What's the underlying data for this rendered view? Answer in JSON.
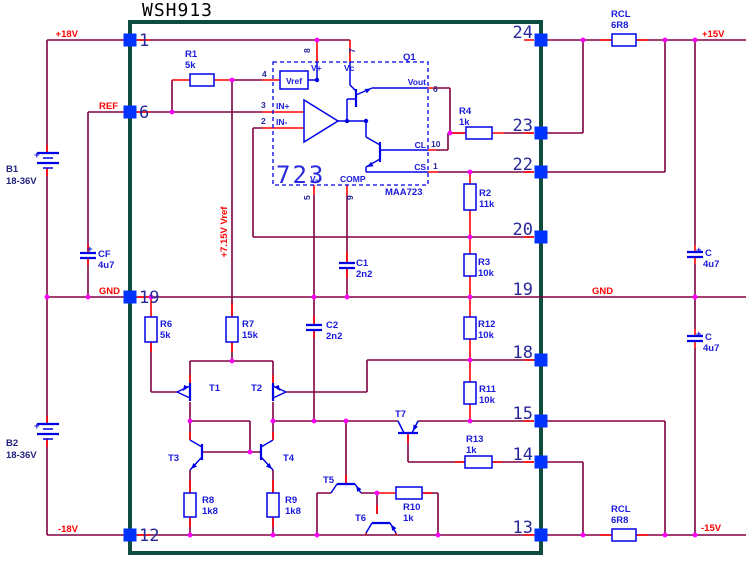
{
  "ic": {
    "title": "WSH913",
    "regulator_label": "723",
    "regulator_part": "MAA723",
    "regulator_designator": "Q1"
  },
  "pins": {
    "left": [
      {
        "n": "1",
        "y": 40
      },
      {
        "n": "6",
        "y": 112
      },
      {
        "n": "19",
        "y": 297
      },
      {
        "n": "12",
        "y": 535
      }
    ],
    "right": [
      {
        "n": "24",
        "y": 40
      },
      {
        "n": "23",
        "y": 133
      },
      {
        "n": "22",
        "y": 172
      },
      {
        "n": "20",
        "y": 237
      },
      {
        "n": "19",
        "y": 297,
        "square": false
      },
      {
        "n": "18",
        "y": 360
      },
      {
        "n": "15",
        "y": 421
      },
      {
        "n": "14",
        "y": 462
      },
      {
        "n": "13",
        "y": 535
      }
    ]
  },
  "labels": [
    {
      "name": "title",
      "text": "WSH913",
      "x": 142,
      "y": 16,
      "cls": "t-title"
    },
    {
      "name": "net-p18v",
      "text": "+18V",
      "x": 78,
      "y": 37,
      "cls": "t-net",
      "anchor": "end"
    },
    {
      "name": "net-ref",
      "text": "REF",
      "x": 118,
      "y": 109,
      "cls": "t-net",
      "anchor": "end"
    },
    {
      "name": "net-gnd-left",
      "text": "GND",
      "x": 120,
      "y": 294,
      "cls": "t-net",
      "anchor": "end"
    },
    {
      "name": "net-m18v",
      "text": "-18V",
      "x": 78,
      "y": 532,
      "cls": "t-net",
      "anchor": "end"
    },
    {
      "name": "net-p15v",
      "text": "+15V",
      "x": 702,
      "y": 37,
      "cls": "t-net"
    },
    {
      "name": "net-gnd-right",
      "text": "GND",
      "x": 592,
      "y": 294,
      "cls": "t-net"
    },
    {
      "name": "net-m15v",
      "text": "-15V",
      "x": 701,
      "y": 531,
      "cls": "t-net"
    },
    {
      "name": "net-vref-rail",
      "text": "+7.15V Vref",
      "x": 227,
      "y": 232,
      "cls": "t-net",
      "anchor": "middle",
      "rot": -90
    },
    {
      "name": "b1-ref",
      "text": "B1",
      "x": 6,
      "y": 172,
      "cls": "t-bat"
    },
    {
      "name": "b1-val",
      "text": "18-36V",
      "x": 6,
      "y": 184,
      "cls": "t-bat"
    },
    {
      "name": "b2-ref",
      "text": "B2",
      "x": 6,
      "y": 446,
      "cls": "t-bat"
    },
    {
      "name": "b2-val",
      "text": "18-36V",
      "x": 6,
      "y": 458,
      "cls": "t-bat"
    },
    {
      "name": "b1-plus",
      "text": "+",
      "x": 34,
      "y": 158,
      "cls": "t-cmp"
    },
    {
      "name": "b2-plus",
      "text": "+",
      "x": 34,
      "y": 429,
      "cls": "t-cmp"
    },
    {
      "name": "r1-ref",
      "text": "R1",
      "x": 185,
      "y": 57,
      "cls": "t-cmp"
    },
    {
      "name": "r1-val",
      "text": "5k",
      "x": 185,
      "y": 68,
      "cls": "t-cmp"
    },
    {
      "name": "r4-ref",
      "text": "R4",
      "x": 459,
      "y": 114,
      "cls": "t-cmp"
    },
    {
      "name": "r4-val",
      "text": "1k",
      "x": 459,
      "y": 125,
      "cls": "t-cmp"
    },
    {
      "name": "rcl-top-ref",
      "text": "RCL",
      "x": 611,
      "y": 17,
      "cls": "t-cmp"
    },
    {
      "name": "rcl-top-val",
      "text": "6R8",
      "x": 611,
      "y": 28,
      "cls": "t-cmp"
    },
    {
      "name": "rcl-bot-ref",
      "text": "RCL",
      "x": 611,
      "y": 512,
      "cls": "t-cmp"
    },
    {
      "name": "rcl-bot-val",
      "text": "6R8",
      "x": 611,
      "y": 523,
      "cls": "t-cmp"
    },
    {
      "name": "r2-ref",
      "text": "R2",
      "x": 479,
      "y": 196,
      "cls": "t-cmp"
    },
    {
      "name": "r2-val",
      "text": "11k",
      "x": 479,
      "y": 207,
      "cls": "t-cmp"
    },
    {
      "name": "r3-ref",
      "text": "R3",
      "x": 478,
      "y": 265,
      "cls": "t-cmp"
    },
    {
      "name": "r3-val",
      "text": "10k",
      "x": 478,
      "y": 276,
      "cls": "t-cmp"
    },
    {
      "name": "r12-ref",
      "text": "R12",
      "x": 478,
      "y": 327,
      "cls": "t-cmp"
    },
    {
      "name": "r12-val",
      "text": "10k",
      "x": 478,
      "y": 338,
      "cls": "t-cmp"
    },
    {
      "name": "r11-ref",
      "text": "R11",
      "x": 479,
      "y": 392,
      "cls": "t-cmp"
    },
    {
      "name": "r11-val",
      "text": "10k",
      "x": 479,
      "y": 403,
      "cls": "t-cmp"
    },
    {
      "name": "r13-ref",
      "text": "R13",
      "x": 466,
      "y": 442,
      "cls": "t-cmp"
    },
    {
      "name": "r13-val",
      "text": "1k",
      "x": 466,
      "y": 453,
      "cls": "t-cmp"
    },
    {
      "name": "r10-ref",
      "text": "R10",
      "x": 403,
      "y": 510,
      "cls": "t-cmp"
    },
    {
      "name": "r10-val",
      "text": "1k",
      "x": 403,
      "y": 521,
      "cls": "t-cmp"
    },
    {
      "name": "r6-ref",
      "text": "R6",
      "x": 160,
      "y": 327,
      "cls": "t-cmp"
    },
    {
      "name": "r6-val",
      "text": "5k",
      "x": 160,
      "y": 338,
      "cls": "t-cmp"
    },
    {
      "name": "r7-ref",
      "text": "R7",
      "x": 242,
      "y": 327,
      "cls": "t-cmp"
    },
    {
      "name": "r7-val",
      "text": "15k",
      "x": 242,
      "y": 338,
      "cls": "t-cmp"
    },
    {
      "name": "r8-ref",
      "text": "R8",
      "x": 202,
      "y": 503,
      "cls": "t-cmp"
    },
    {
      "name": "r8-val",
      "text": "1k8",
      "x": 202,
      "y": 514,
      "cls": "t-cmp"
    },
    {
      "name": "r9-ref",
      "text": "R9",
      "x": 285,
      "y": 503,
      "cls": "t-cmp"
    },
    {
      "name": "r9-val",
      "text": "1k8",
      "x": 285,
      "y": 514,
      "cls": "t-cmp"
    },
    {
      "name": "c1-ref",
      "text": "C1",
      "x": 356,
      "y": 266,
      "cls": "t-cmp"
    },
    {
      "name": "c1-val",
      "text": "2n2",
      "x": 356,
      "y": 277,
      "cls": "t-cmp"
    },
    {
      "name": "c2-ref",
      "text": "C2",
      "x": 326,
      "y": 328,
      "cls": "t-cmp"
    },
    {
      "name": "c2-val",
      "text": "2n2",
      "x": 326,
      "y": 339,
      "cls": "t-cmp"
    },
    {
      "name": "cf-plus",
      "text": "+",
      "x": 87,
      "y": 252,
      "cls": "t-cmp"
    },
    {
      "name": "cf-ref",
      "text": "CF",
      "x": 98,
      "y": 257,
      "cls": "t-cmp"
    },
    {
      "name": "cf-val",
      "text": "4u7",
      "x": 98,
      "y": 268,
      "cls": "t-cmp"
    },
    {
      "name": "cr1-plus",
      "text": "+",
      "x": 696,
      "y": 253,
      "cls": "t-cmp"
    },
    {
      "name": "cr1-ref",
      "text": "C",
      "x": 705,
      "y": 256,
      "cls": "t-cmp"
    },
    {
      "name": "cr1-val",
      "text": "4u7",
      "x": 703,
      "y": 267,
      "cls": "t-cmp"
    },
    {
      "name": "cr2-plus",
      "text": "+",
      "x": 696,
      "y": 337,
      "cls": "t-cmp"
    },
    {
      "name": "cr2-ref",
      "text": "C",
      "x": 705,
      "y": 340,
      "cls": "t-cmp"
    },
    {
      "name": "cr2-val",
      "text": "4u7",
      "x": 703,
      "y": 351,
      "cls": "t-cmp"
    },
    {
      "name": "t1-ref",
      "text": "T1",
      "x": 209,
      "y": 391,
      "cls": "t-cmp"
    },
    {
      "name": "t2-ref",
      "text": "T2",
      "x": 251,
      "y": 391,
      "cls": "t-cmp"
    },
    {
      "name": "t3-ref",
      "text": "T3",
      "x": 168,
      "y": 461,
      "cls": "t-cmp"
    },
    {
      "name": "t4-ref",
      "text": "T4",
      "x": 283,
      "y": 461,
      "cls": "t-cmp"
    },
    {
      "name": "t5-ref",
      "text": "T5",
      "x": 323,
      "y": 483,
      "cls": "t-cmp"
    },
    {
      "name": "t6-ref",
      "text": "T6",
      "x": 355,
      "y": 521,
      "cls": "t-cmp"
    },
    {
      "name": "t7-ref",
      "text": "T7",
      "x": 395,
      "y": 417,
      "cls": "t-cmp"
    },
    {
      "name": "q1-ref",
      "text": "Q1",
      "x": 403,
      "y": 60,
      "cls": "t-cmp"
    },
    {
      "name": "maa723",
      "text": "MAA723",
      "x": 385,
      "y": 195,
      "cls": "t-cmp"
    },
    {
      "name": "big-723",
      "text": "723",
      "x": 276,
      "y": 183,
      "cls": "t-big"
    },
    {
      "name": "ic-vref",
      "text": "Vref",
      "x": 294,
      "y": 84,
      "cls": "t-ic",
      "anchor": "middle"
    },
    {
      "name": "ic-vplus",
      "text": "V+",
      "x": 311,
      "y": 71,
      "cls": "t-ic"
    },
    {
      "name": "ic-vc",
      "text": "Vc",
      "x": 344,
      "y": 71,
      "cls": "t-ic"
    },
    {
      "name": "ic-vminus",
      "text": "V-",
      "x": 310,
      "y": 182,
      "cls": "t-ic"
    },
    {
      "name": "ic-comp",
      "text": "COMP",
      "x": 340,
      "y": 182,
      "cls": "t-ic"
    },
    {
      "name": "ic-inp",
      "text": "IN+",
      "x": 276,
      "y": 109,
      "cls": "t-ic"
    },
    {
      "name": "ic-inm",
      "text": "IN-",
      "x": 276,
      "y": 125,
      "cls": "t-ic"
    },
    {
      "name": "ic-vout",
      "text": "Vout",
      "x": 426,
      "y": 85,
      "cls": "t-ic",
      "anchor": "end"
    },
    {
      "name": "ic-cl",
      "text": "CL",
      "x": 426,
      "y": 148,
      "cls": "t-ic",
      "anchor": "end"
    },
    {
      "name": "ic-cs",
      "text": "CS",
      "x": 426,
      "y": 170,
      "cls": "t-ic",
      "anchor": "end"
    },
    {
      "name": "icnum-4",
      "text": "4",
      "x": 262,
      "y": 77,
      "cls": "t-icnum"
    },
    {
      "name": "icnum-3",
      "text": "3",
      "x": 261,
      "y": 108,
      "cls": "t-icnum"
    },
    {
      "name": "icnum-2",
      "text": "2",
      "x": 261,
      "y": 124,
      "cls": "t-icnum"
    },
    {
      "name": "icnum-6",
      "text": "6",
      "x": 433,
      "y": 92,
      "cls": "t-icnum"
    },
    {
      "name": "icnum-10",
      "text": "10",
      "x": 431,
      "y": 147,
      "cls": "t-icnum"
    },
    {
      "name": "icnum-1",
      "text": "1",
      "x": 433,
      "y": 169,
      "cls": "t-icnum"
    },
    {
      "name": "icnum-8",
      "text": "8",
      "x": 310,
      "y": 53,
      "cls": "t-icnum",
      "rot": -90
    },
    {
      "name": "icnum-7",
      "text": "7",
      "x": 355,
      "y": 53,
      "cls": "t-icnum",
      "rot": -90
    },
    {
      "name": "icnum-5",
      "text": "5",
      "x": 310,
      "y": 200,
      "cls": "t-icnum",
      "rot": -90
    },
    {
      "name": "icnum-9",
      "text": "9",
      "x": 353,
      "y": 200,
      "cls": "t-icnum",
      "rot": -90
    }
  ]
}
